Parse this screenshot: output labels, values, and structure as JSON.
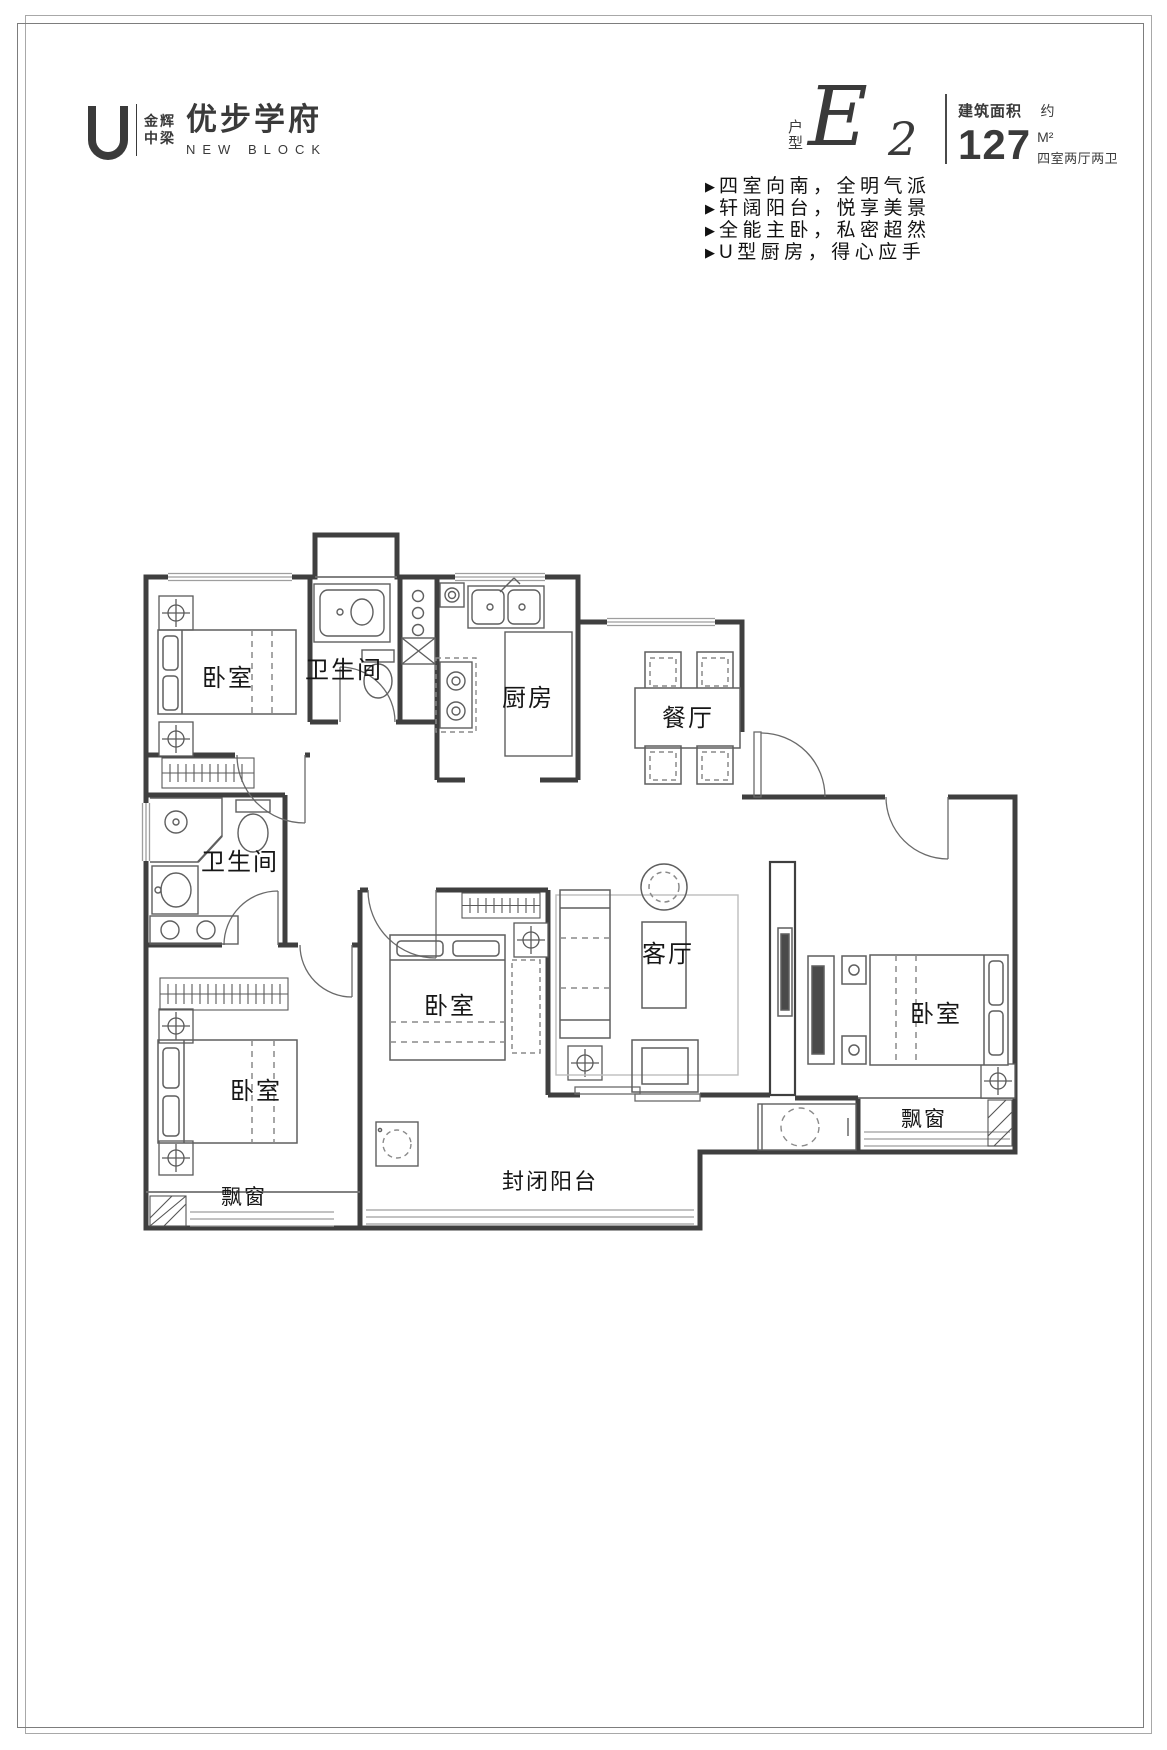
{
  "logo": {
    "brand_line1": "金辉",
    "brand_line2": "中梁",
    "name": "优步学府",
    "subtitle": "NEW BLOCK"
  },
  "unit": {
    "type_label": "户型",
    "model_letter": "E",
    "model_number": "2",
    "area_title": "建筑面积",
    "area_approx": "约",
    "area_value": "127",
    "area_unit": "M²",
    "rooms_summary": "四室两厅两卫"
  },
  "features": {
    "bullet": "▶",
    "items": [
      "四室向南，全明气派",
      "轩阔阳台，悦享美景",
      "全能主卧，私密超然",
      "U型厨房，得心应手"
    ]
  },
  "plan": {
    "labels": {
      "bedroom_topleft": "卧室",
      "bathroom_top": "卫生间",
      "kitchen": "厨房",
      "dining": "餐厅",
      "bathroom_left": "卫生间",
      "living": "客厅",
      "bedroom_middle": "卧室",
      "bedroom_master": "卧室",
      "bedroom_bottomleft": "卧室",
      "bay_window_left": "飘窗",
      "bay_window_right": "飘窗",
      "balcony": "封闭阳台"
    }
  }
}
